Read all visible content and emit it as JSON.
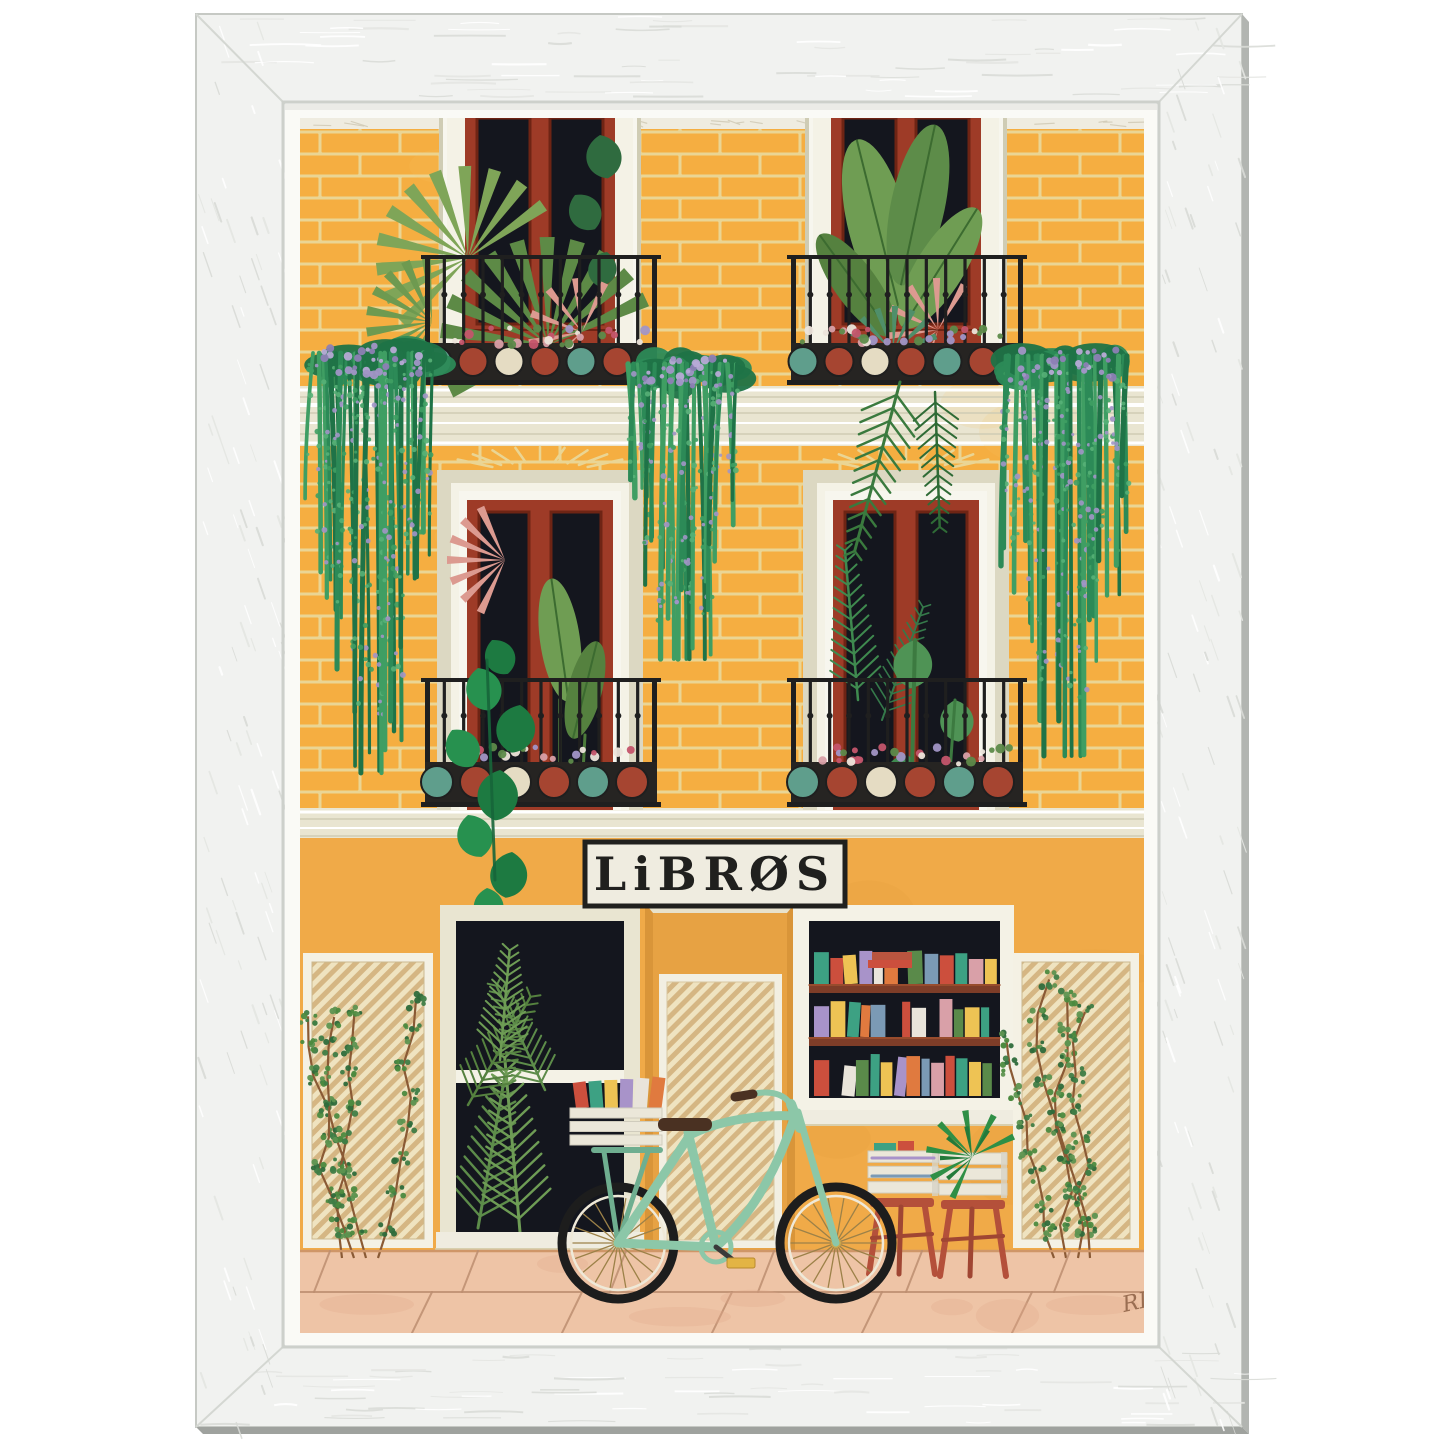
{
  "sign": {
    "text": "LiBRØS"
  },
  "signature": {
    "text": "RL"
  },
  "palette": {
    "frame_wood": "#f1f2f0",
    "frame_grain": "#d9dbd7",
    "frame_edge": "#b2b5b1",
    "frame_edge_dark": "#9fa29e",
    "mat": "#fafaf6",
    "brick": "#f5ae41",
    "mortar": "#ead594",
    "shop_wall": "#f0aa48",
    "door_recess": "#e7a243",
    "cream_light": "#f4f2e6",
    "cream": "#e9e5d1",
    "cream_dark": "#cfccb4",
    "window_red": "#9e3b27",
    "window_red_dark": "#6e2414",
    "glass": "#14161e",
    "iron": "#1f1f1f",
    "shelf_brown": "#7e3d28",
    "mint": "#8cc7a8",
    "mint_dark": "#6fae90",
    "tire": "#1d1d1d",
    "spoke": "#9c8148",
    "saddle": "#4a3122",
    "crate": "#ebe7d9",
    "crate_shadow": "#d7d3c5",
    "stool": "#b4503a",
    "stool_dark": "#a04633",
    "pavement": "#eec4a6",
    "pavement_line": "#bd8e70",
    "hatch_a": "#efe3c0",
    "hatch_b": "#d5b683",
    "sign_bg": "#efece0",
    "sign_ink": "#20201e",
    "wisteria_dark": "#1f7347",
    "wisteria_mid": "#2c8a57",
    "wisteria_light": "#3f9e63",
    "wisteria_flower": "#a195c6",
    "leaf_dark": "#2f6b3f",
    "leaf_mid": "#55813f",
    "leaf_light": "#7fa558",
    "leaf_bright": "#27914f",
    "philo": "#1d7a41",
    "pink_leaf": "#dc9a90",
    "agave": "#4f8f6a",
    "box_red": "#a64531",
    "box_teal": "#5f9e8c",
    "box_cream": "#e5dcc3",
    "flower_white": "#ece4da",
    "flower_pink": "#d9a0a8",
    "stem_brown": "#8a5a35",
    "pedal": "#e3b445"
  },
  "books": {
    "shelf_rows": [
      [
        "#3da183",
        "#cc4f3d",
        "#eec354",
        "#a893c9",
        "#e9e4da",
        "#e07a3f",
        "#5a8a4a",
        "#7b9ab5",
        "#cc4f3d",
        "#3da183",
        "#d9a0a8",
        "#eec354",
        "#4f6f9f",
        "#b8553f"
      ],
      [
        "#a893c9",
        "#eec354",
        "#3da183",
        "#e07a3f",
        "#7b9ab5",
        "#cc4f3d",
        "#e9e4da",
        "#d9a0a8",
        "#5a8a4a",
        "#eec354",
        "#3da183",
        "#b8553f",
        "#a893c9",
        "#4f6f9f"
      ],
      [
        "#cc4f3d",
        "#e9e4da",
        "#5a8a4a",
        "#3da183",
        "#eec354",
        "#a893c9",
        "#e07a3f",
        "#7b9ab5",
        "#d9a0a8",
        "#cc4f3d",
        "#3da183",
        "#eec354",
        "#5a8a4a",
        "#b8553f"
      ]
    ],
    "crate": [
      "#cc4f3d",
      "#3da183",
      "#eec354",
      "#a893c9",
      "#e9e4da",
      "#e07a3f"
    ],
    "stool": [
      "#3da183",
      "#cc4f3d",
      "#a893c9",
      "#7b9ab5"
    ]
  }
}
